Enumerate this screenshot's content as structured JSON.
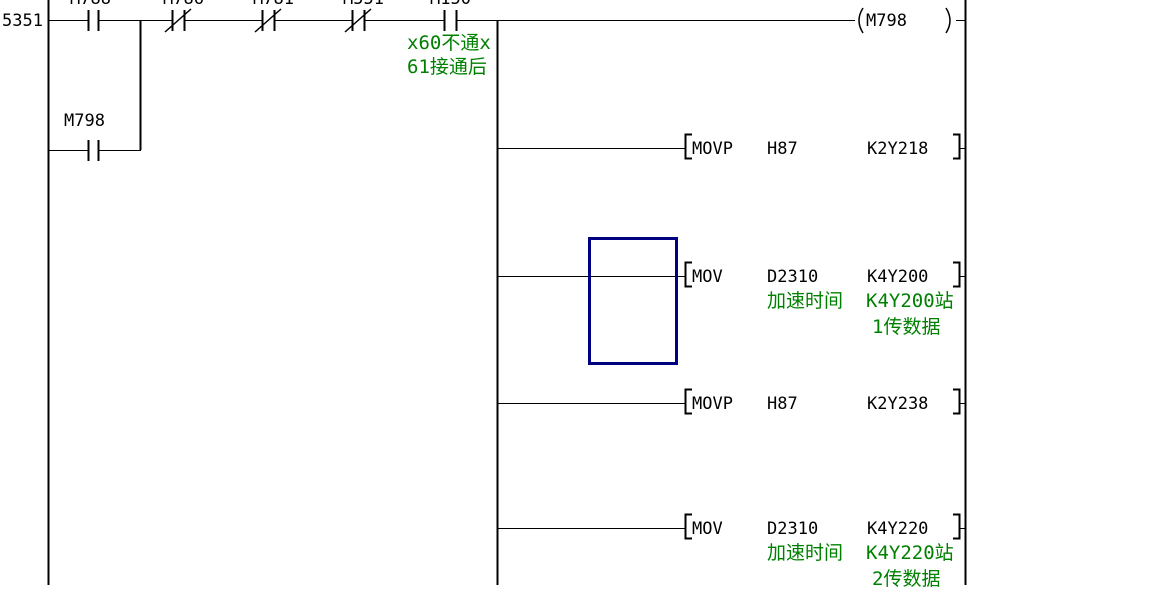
{
  "colors": {
    "wire": "#000000",
    "comment_green": "#008000",
    "cursor_navy": "#000080",
    "background": "#ffffff"
  },
  "rung": {
    "step_number": "5351",
    "coil_device": "M798",
    "comment_line1": "x60不通x",
    "comment_line2": "61接通后"
  },
  "contacts": [
    {
      "label": "M788",
      "type": "NO"
    },
    {
      "label": "M786",
      "type": "NC"
    },
    {
      "label": "M781",
      "type": "NC"
    },
    {
      "label": "M551",
      "type": "NC"
    },
    {
      "label": "M150",
      "type": "NO"
    }
  ],
  "branch_contact": {
    "label": "M798",
    "type": "NO"
  },
  "symbols": {
    "open_bracket": "[",
    "close_bracket": "]",
    "coil_open": "(",
    "coil_close": ")"
  },
  "instructions": [
    {
      "opcode": "MOVP",
      "operand1": "H87",
      "operand2": "K2Y218"
    },
    {
      "opcode": "MOV",
      "operand1": "D2310",
      "operand2": "K4Y200",
      "comment_operand1": "加速时间",
      "comment_operand2_line1": "K4Y200站",
      "comment_operand2_line2": "1传数据"
    },
    {
      "opcode": "MOVP",
      "operand1": "H87",
      "operand2": "K2Y238"
    },
    {
      "opcode": "MOV",
      "operand1": "D2310",
      "operand2": "K4Y220",
      "comment_operand1": "加速时间",
      "comment_operand2_line1": "K4Y220站",
      "comment_operand2_line2": "2传数据"
    }
  ]
}
